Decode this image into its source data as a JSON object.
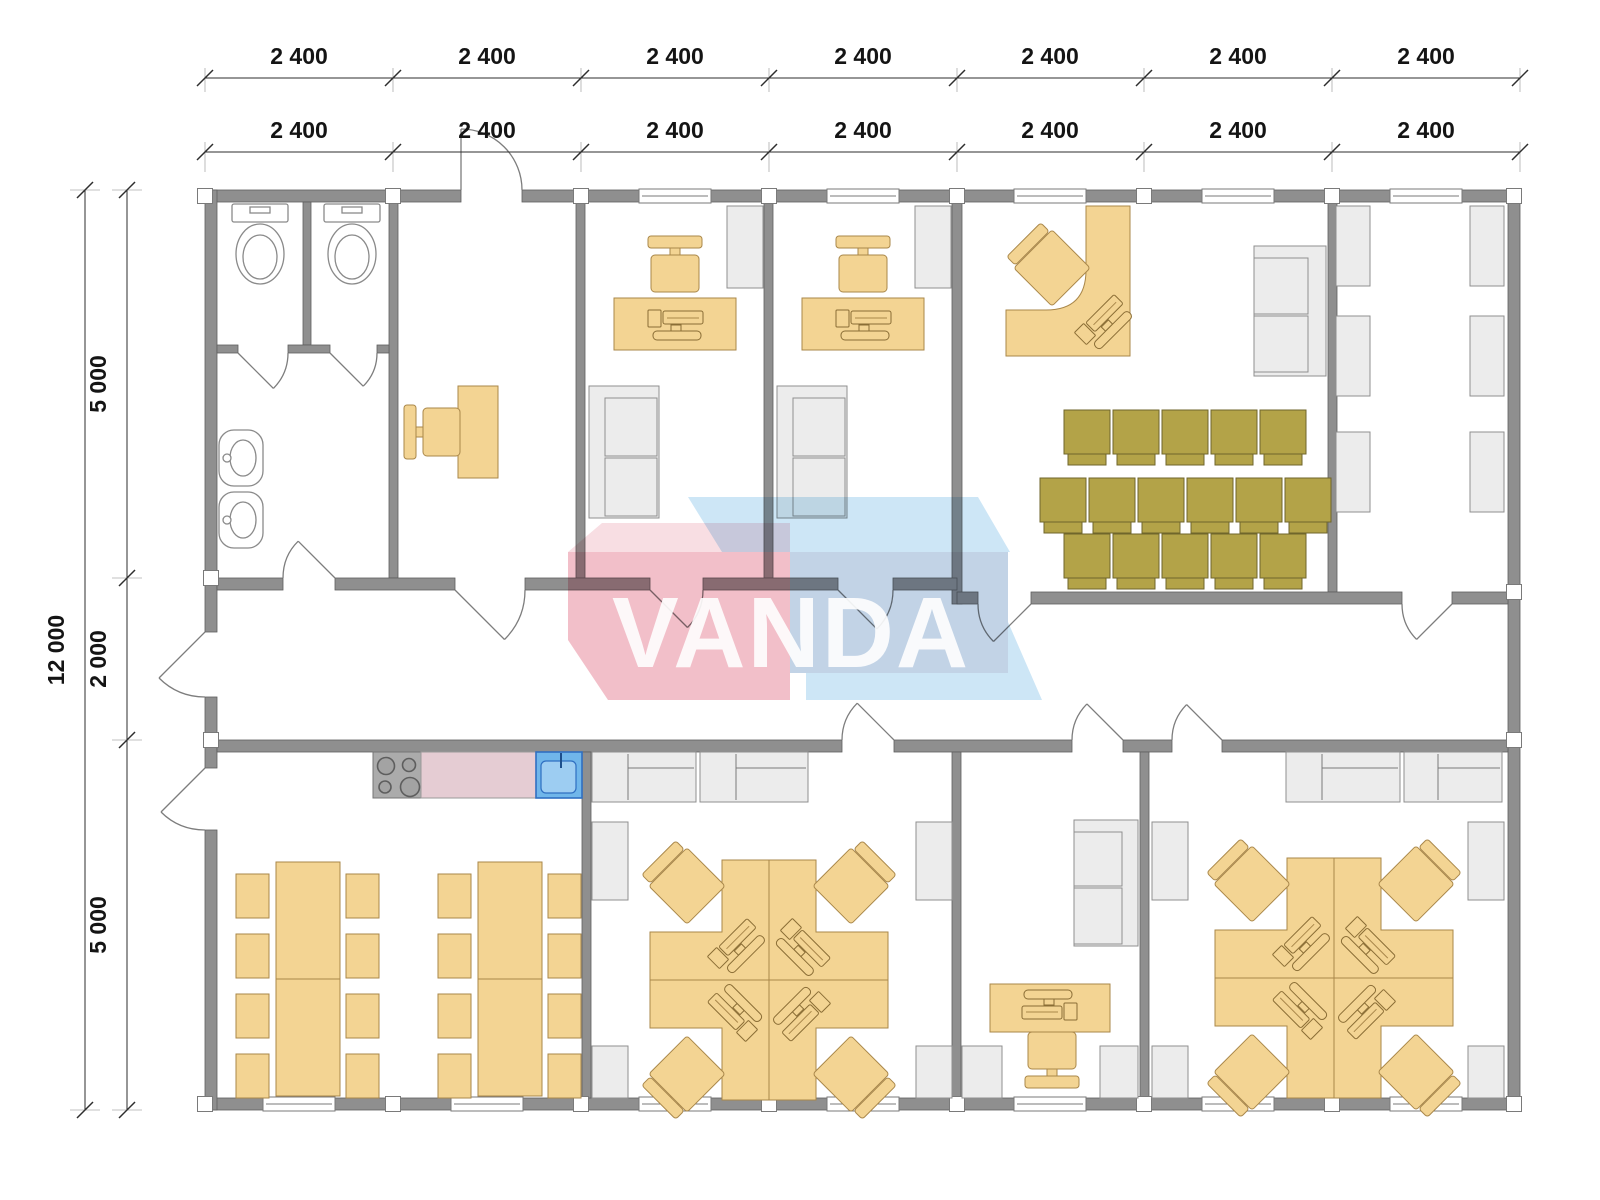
{
  "logo": {
    "brand": "VANDA"
  },
  "dimensions": {
    "top_outer": [
      "2 400",
      "2 400",
      "2 400",
      "2 400",
      "2 400",
      "2 400",
      "2 400"
    ],
    "top_inner": [
      "2 400",
      "2 400",
      "2 400",
      "2 400",
      "2 400",
      "2 400",
      "2 400"
    ],
    "left_total": "12 000",
    "left_segments": [
      "5 000",
      "2 000",
      "5 000"
    ]
  },
  "colors": {
    "wall": "#8f8f8f",
    "furnTan": "#f3d493",
    "furnTanStroke": "#a9874a",
    "olive": "#b3a348",
    "oliveStroke": "#6f662b",
    "furnGray": "#ececec",
    "counterPink": "#e5ccd3",
    "sinkBlue": "#70b6ea",
    "sinkBlueStroke": "#2f6fc1",
    "logoPink": "#f2bfc9",
    "logoPinkLight": "#f8dee3",
    "logoBlue": "#c2d3e6",
    "logoBlueLight": "#cde6f6"
  }
}
